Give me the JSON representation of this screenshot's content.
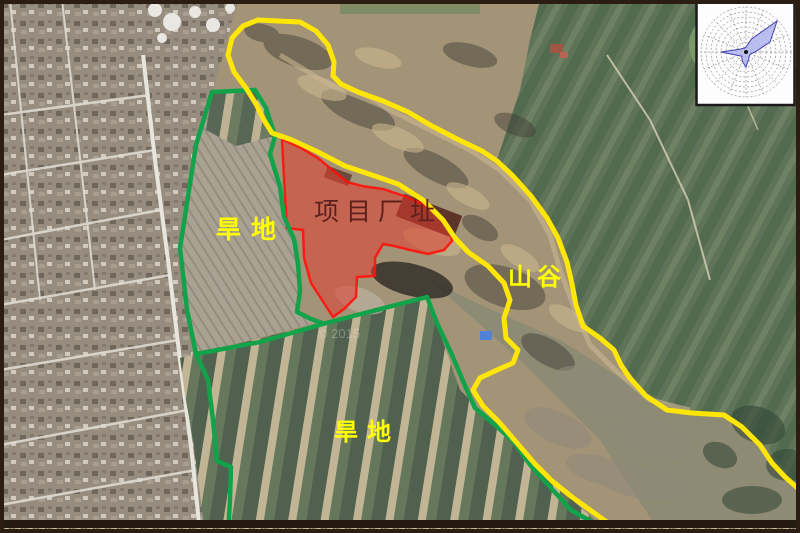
{
  "labels": {
    "project_site": "项目厂址",
    "dryland_upper": "旱地",
    "valley": "山谷",
    "dryland_lower": "旱地"
  },
  "watermark": "© 2015",
  "colors": {
    "site_boundary": "#ff120a",
    "site_fill": "#e23c30",
    "parcel_boundary_green": "#12a24a",
    "valley_boundary_yellow": "#ffe607",
    "label_yellow": "#ffff00",
    "site_label_text": "#5c211c"
  },
  "wind_rose": {
    "directions": [
      "N",
      "NNE",
      "NE",
      "ENE",
      "E",
      "ESE",
      "SE",
      "SSE",
      "S",
      "SSW",
      "SW",
      "WSW",
      "W",
      "WNW",
      "NW",
      "NNW"
    ],
    "values": [
      5,
      14,
      44,
      26,
      9,
      5,
      5,
      7,
      15,
      10,
      6,
      9,
      25,
      7,
      5,
      4
    ],
    "max_radius": 45,
    "rings": 9,
    "fill": "#b0b4ef",
    "stroke": "#4242aa"
  }
}
